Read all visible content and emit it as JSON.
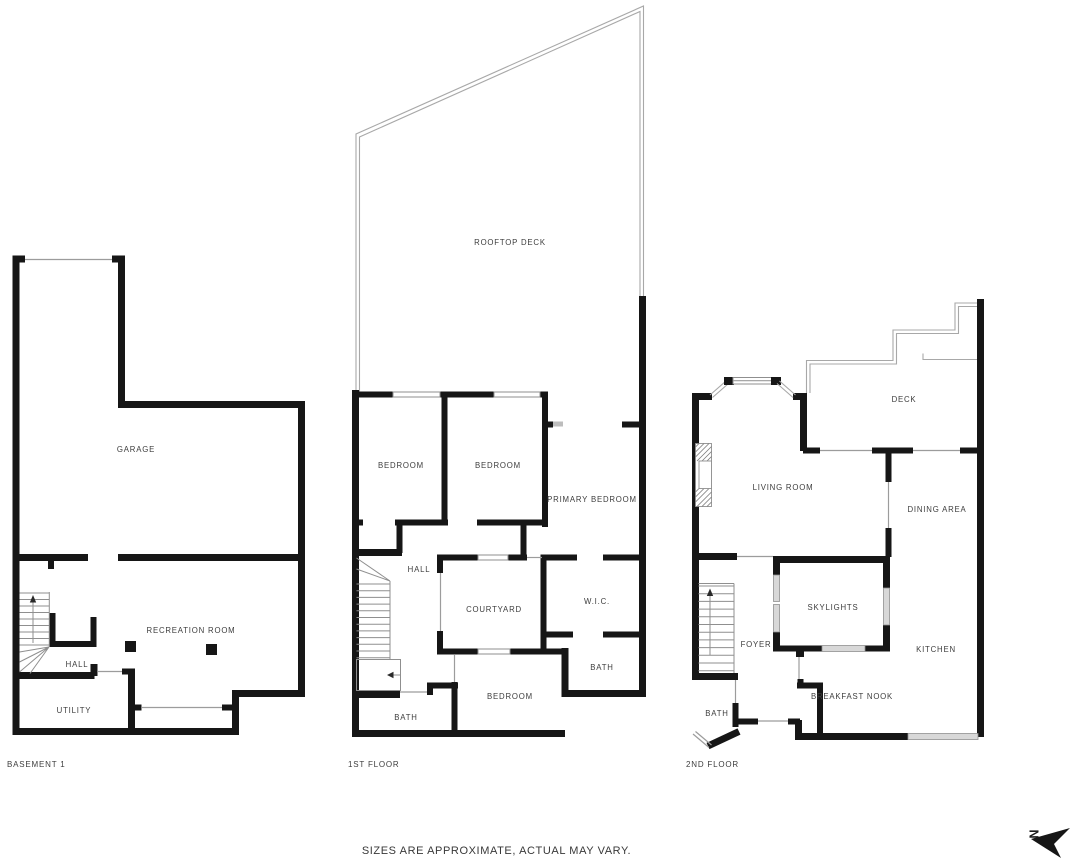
{
  "disclaimer": "SIZES ARE APPROXIMATE, ACTUAL MAY VARY.",
  "compass": {
    "north": "N"
  },
  "colors": {
    "wall": "#161616",
    "thin_line": "#9c9c9c",
    "window_fill": "#d8d8d8",
    "label_text": "#3d3d3d"
  },
  "floors": {
    "basement": {
      "title": "BASEMENT 1",
      "rooms": {
        "garage": "GARAGE",
        "recreation_room": "RECREATION ROOM",
        "hall": "HALL",
        "utility": "UTILITY"
      }
    },
    "first": {
      "title": "1ST FLOOR",
      "rooms": {
        "rooftop_deck": "ROOFTOP DECK",
        "bedroom_left": "BEDROOM",
        "bedroom_mid": "BEDROOM",
        "primary_bedroom": "PRIMARY BEDROOM",
        "hall": "HALL",
        "courtyard": "COURTYARD",
        "wic": "W.I.C.",
        "bath_upper": "BATH",
        "bedroom_lower": "BEDROOM",
        "bath_lower": "BATH"
      }
    },
    "second": {
      "title": "2ND FLOOR",
      "rooms": {
        "living_room": "LIVING ROOM",
        "deck": "DECK",
        "dining_area": "DINING AREA",
        "skylights": "SKYLIGHTS",
        "foyer": "FOYER",
        "kitchen": "KITCHEN",
        "breakfast_nook": "BREAKFAST NOOK",
        "bath": "BATH"
      }
    }
  }
}
